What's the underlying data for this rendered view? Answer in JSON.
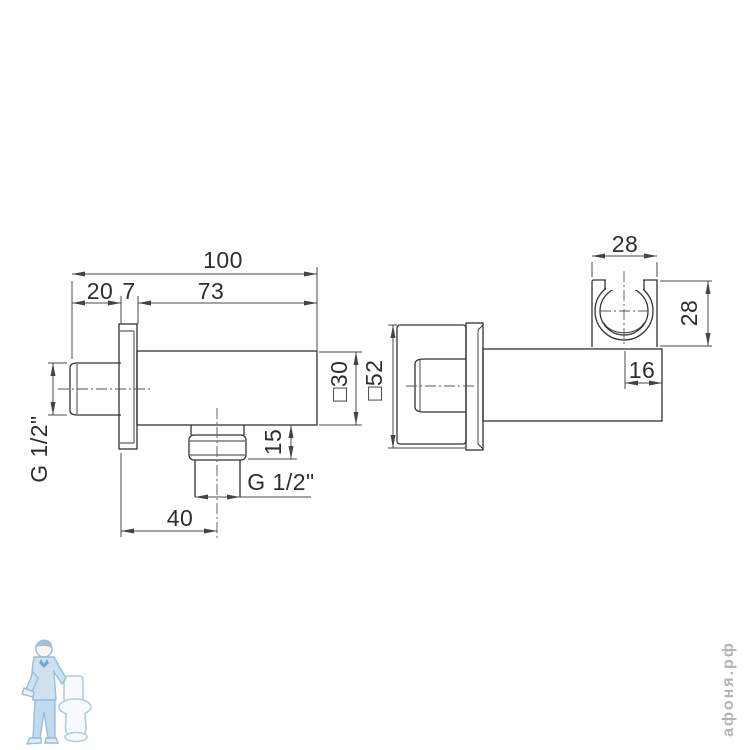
{
  "drawing": {
    "kind": "technical-dimension-drawing",
    "product": "wall shower outlet elbow with handshower holder",
    "line_color": "#3a3a3a",
    "front_view": {
      "overall_width": "100",
      "stub_length": "20",
      "plate_thickness": "7",
      "body_length": "73",
      "inlet_thread": "G 1/2\"",
      "body_square": "□30",
      "outlet_drop": "15",
      "outlet_thread": "G 1/2\"",
      "outlet_offset": "40"
    },
    "side_view": {
      "holder_width": "28",
      "holder_height": "28",
      "holder_end_offset": "16",
      "plate_square": "□52"
    },
    "watermark": {
      "site_text": "афоня.рф",
      "color": "#b4b4b4"
    }
  }
}
